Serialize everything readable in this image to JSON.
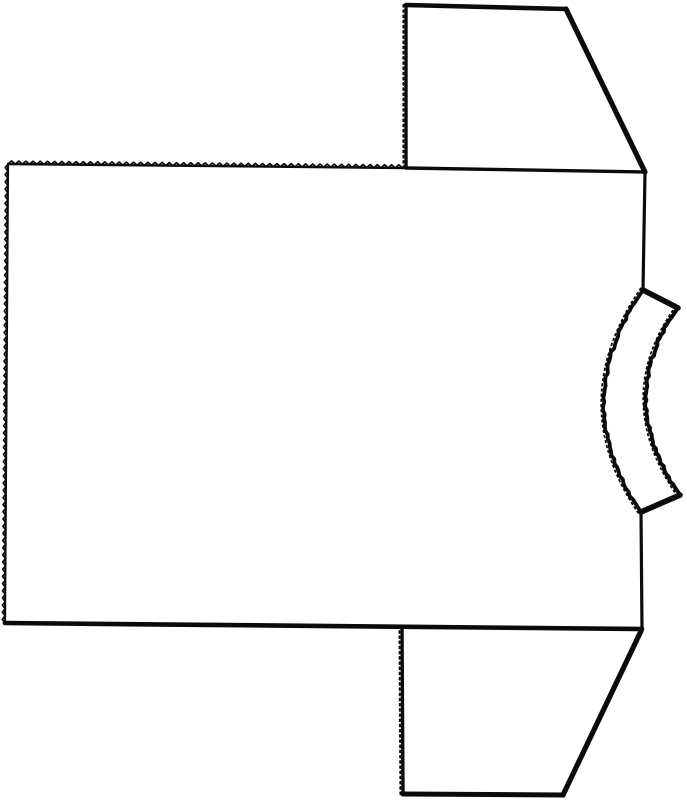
{
  "diagram": {
    "type": "flat-garment-pattern",
    "canvas": {
      "width": 687,
      "height": 800,
      "background": "#ffffff",
      "ink": "#0b0b0b"
    },
    "pieces": [
      {
        "id": "body-panel",
        "edges": [
          {
            "name": "body-top-serrated-edge",
            "kind": "zigzag",
            "from": [
              8,
              164
            ],
            "to": [
              406,
              168
            ],
            "base_width": 2.4,
            "tooth_amp": 3.1,
            "tooth_step": 3.6
          },
          {
            "name": "body-top-right-edge",
            "kind": "line",
            "from": [
              406,
              168
            ],
            "to": [
              645,
              172
            ],
            "width": 3.4
          },
          {
            "name": "body-right-shoulder-edge",
            "kind": "line",
            "from": [
              645,
              172
            ],
            "to": [
              643,
              290
            ],
            "width": 3.2
          },
          {
            "name": "neckline-inner-arc",
            "kind": "arc3",
            "from": [
              643,
              290
            ],
            "mid": [
              604,
              402
            ],
            "to": [
              641,
              512
            ],
            "width": 3.8,
            "rough": true,
            "fray": true
          },
          {
            "name": "body-right-lower-edge",
            "kind": "line",
            "from": [
              641,
              512
            ],
            "to": [
              642,
              629
            ],
            "width": 3.2
          },
          {
            "name": "body-bottom-edge",
            "kind": "line",
            "from": [
              642,
              629
            ],
            "to": [
              5,
              623
            ],
            "width": 4.6
          },
          {
            "name": "body-left-serrated-edge",
            "kind": "zigzag",
            "from": [
              5,
              623
            ],
            "to": [
              8,
              164
            ],
            "base_width": 2.2,
            "tooth_amp": 2.7,
            "tooth_step": 3.6
          }
        ]
      },
      {
        "id": "top-sleeve",
        "edges": [
          {
            "name": "top-sleeve-inner-edge",
            "kind": "line",
            "from": [
              406,
              168
            ],
            "to": [
              406,
              5
            ],
            "width": 3.4,
            "fray": true
          },
          {
            "name": "top-sleeve-end-edge",
            "kind": "line",
            "from": [
              406,
              5
            ],
            "to": [
              566,
              9
            ],
            "width": 4.6
          },
          {
            "name": "top-sleeve-slant-edge",
            "kind": "line",
            "from": [
              566,
              9
            ],
            "to": [
              645,
              172
            ],
            "width": 5.2
          }
        ]
      },
      {
        "id": "bottom-sleeve",
        "edges": [
          {
            "name": "bottom-sleeve-inner-edge",
            "kind": "line",
            "from": [
              403,
              794
            ],
            "to": [
              402,
              627
            ],
            "width": 3.4,
            "fray": true
          },
          {
            "name": "bottom-sleeve-end-edge",
            "kind": "line",
            "from": [
              403,
              794
            ],
            "to": [
              563,
              795
            ],
            "width": 5.0
          },
          {
            "name": "bottom-sleeve-slant-edge",
            "kind": "line",
            "from": [
              563,
              795
            ],
            "to": [
              641,
              631
            ],
            "width": 5.2
          }
        ]
      },
      {
        "id": "neckband",
        "edges": [
          {
            "name": "neckband-top-cut-edge",
            "kind": "line",
            "from": [
              643,
              290
            ],
            "to": [
              678,
              308
            ],
            "width": 5.6
          },
          {
            "name": "neckband-outer-arc",
            "kind": "arc3",
            "from": [
              678,
              308
            ],
            "mid": [
              646,
              400
            ],
            "to": [
              680,
              495
            ],
            "width": 4.0,
            "rough": true,
            "fray": true
          },
          {
            "name": "neckband-bottom-cut-edge",
            "kind": "line",
            "from": [
              680,
              495
            ],
            "to": [
              641,
              512
            ],
            "width": 5.6
          }
        ]
      }
    ]
  }
}
